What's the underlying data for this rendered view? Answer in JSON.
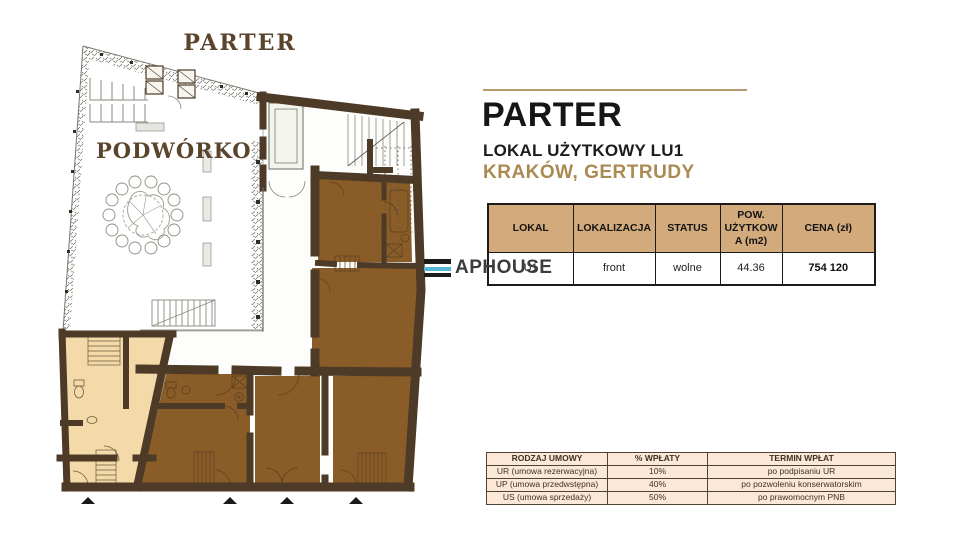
{
  "plan": {
    "title": "PARTER",
    "courtyard_label": "PODWÓRKO",
    "colors": {
      "wall": "#4d3a27",
      "room_brown": "#8a5d28",
      "room_tan": "#f4daa8",
      "label_brown": "#5a452c"
    }
  },
  "panel": {
    "heading": "PARTER",
    "subheading": "LOKAL UŻYTKOWY LU1",
    "location": "KRAKÓW, GERTRUDY",
    "accent_color": "#ab8a52",
    "rule_color": "#b49a6c"
  },
  "watermark": {
    "text": "APHOUSE",
    "bar_colors": [
      "#1c1c1c",
      "#55b7d9",
      "#1c1c1c"
    ]
  },
  "offer_table": {
    "headers": [
      "LOKAL",
      "LOKALIZACJA",
      "STATUS",
      "POW. UŻYTKOWA (m2)",
      "CENA (zł)"
    ],
    "row": {
      "lokal": "U1",
      "lokalizacja": "front",
      "status": "wolne",
      "pow_uzytkowa_m2": "44.36",
      "cena_zl": "754 120"
    },
    "header_bg": "#d2aa7c"
  },
  "payment_table": {
    "headers": [
      "RODZAJ UMOWY",
      "% WPŁATY",
      "TERMIN WPŁAT"
    ],
    "rows": [
      {
        "rodzaj": "UR (umowa rezerwacyjna)",
        "procent": "10%",
        "termin": "po podpisaniu UR"
      },
      {
        "rodzaj": "UP (umowa przedwstępna)",
        "procent": "40%",
        "termin": "po pozwoleniu konserwatorskim"
      },
      {
        "rodzaj": "US (umowa sprzedaży)",
        "procent": "50%",
        "termin": "po prawomocnym PNB"
      }
    ],
    "row_bg": "#fce8d7"
  }
}
